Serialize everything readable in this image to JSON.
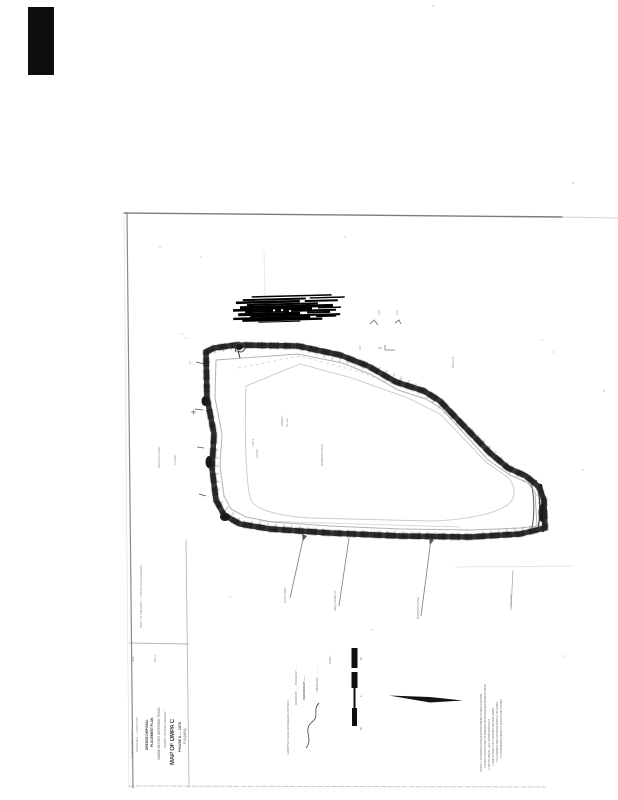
{
  "colors": {
    "ink": "#242424",
    "faint": "#8a8a8a",
    "redaction": "#000000"
  },
  "titleblock": {
    "t1": "SHAW & ASSOC. INC.",
    "t2": "ENGINEERS — SURVEYORS",
    "t3": "DREDGE DISPOSAL",
    "t4": "PLACEMENT PLAN",
    "t5": "SABINE-NECHES WATERWAY, TEXAS",
    "t6": "VICINITY OF PORT ARTHUR",
    "t7": "MAP OF DMPA C",
    "t8": "PHASE II — 1976",
    "t9": "P-III (MPA)"
  },
  "approvals": {
    "a1": "SUBMITTED: CHIEF, ENGINEERING DIVISION",
    "a2": "DRAWN BY ........  TRACED BY ........",
    "a3": "CHECKED BY ........",
    "a4": "APPROVED ................",
    "a5": "DATE ...."
  },
  "notes": {
    "n1": "NOTES: 1. SOUNDINGS AND ELEVATIONS REFER TO MEAN LOW TIDE.",
    "n2": "2. DIKES CONSTRUCTED OF MATERIAL FROM ADJACENT BORROW DITCH.",
    "n3": "3. TOP OF DIKE EL +12.0, CROWN WIDTH 5 FT.",
    "n4": "4. SIDE SLOPES 1 ON 3, EXISTING GROUND VARIES.",
    "n5": "5. PLACEMENT AREA CONTAINS APPROX. 167 ACRES.",
    "n6": "6. COORDINATES REFER TO STATE PLANE SYSTEM."
  },
  "map_labels": {
    "area": "DMPA C",
    "area_el": "EL +9.0",
    "slope1": "1 ON 3",
    "slope2": "SLOPE",
    "ditch": "BORROW DITCH",
    "sta": "DIKE STA",
    "spot1": "11.6",
    "spot2": "11.4",
    "spot3": "10.8",
    "spot4": "12",
    "levee": "EXISTING LEVEE",
    "cl": "CL DIKE",
    "b1": "EXIST. DIKE",
    "b2": "NEW LEVEE CL",
    "b3": "BORROW DITCH",
    "b4": "SPILLWAY"
  },
  "margin": {
    "left_col": "DEPT. OF THE ARMY — CORPS OF ENGINEERS",
    "file": "FILE",
    "no": "NO. 4",
    "tick1": "40",
    "tick2": "0",
    "tick3": "40"
  }
}
